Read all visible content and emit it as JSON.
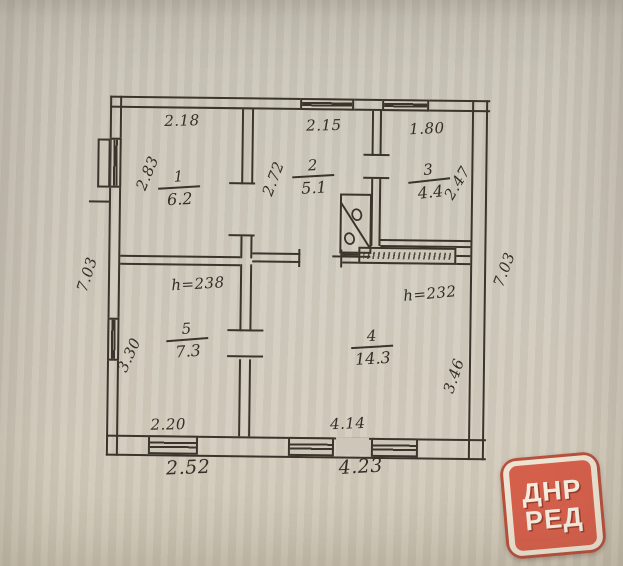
{
  "plan": {
    "rooms": [
      {
        "num": "1",
        "area": "6.2"
      },
      {
        "num": "2",
        "area": "5.1"
      },
      {
        "num": "3",
        "area": "4.4"
      },
      {
        "num": "4",
        "area": "14.3"
      },
      {
        "num": "5",
        "area": "7.3"
      }
    ],
    "heights": {
      "room5": "h=238",
      "room4": "h=232"
    },
    "dimensions": {
      "top_room1": "2.18",
      "top_room2": "2.15",
      "top_room3": "1.80",
      "left_room1": "2.83",
      "wall_1_2": "2.72",
      "right_room3": "2.47",
      "left_total": "7.03",
      "right_total": "7.03",
      "left_room5": "3.30",
      "right_room4": "3.46",
      "bottom_room5_inner": "2.20",
      "bottom_room5_outer": "2.52",
      "bottom_room4_inner": "4.14",
      "bottom_room4_outer": "4.23"
    }
  },
  "watermark": {
    "line1": "ДНР",
    "line2": "РЕД",
    "bg": "#d4604c",
    "text_color": "#f3ecdf"
  }
}
